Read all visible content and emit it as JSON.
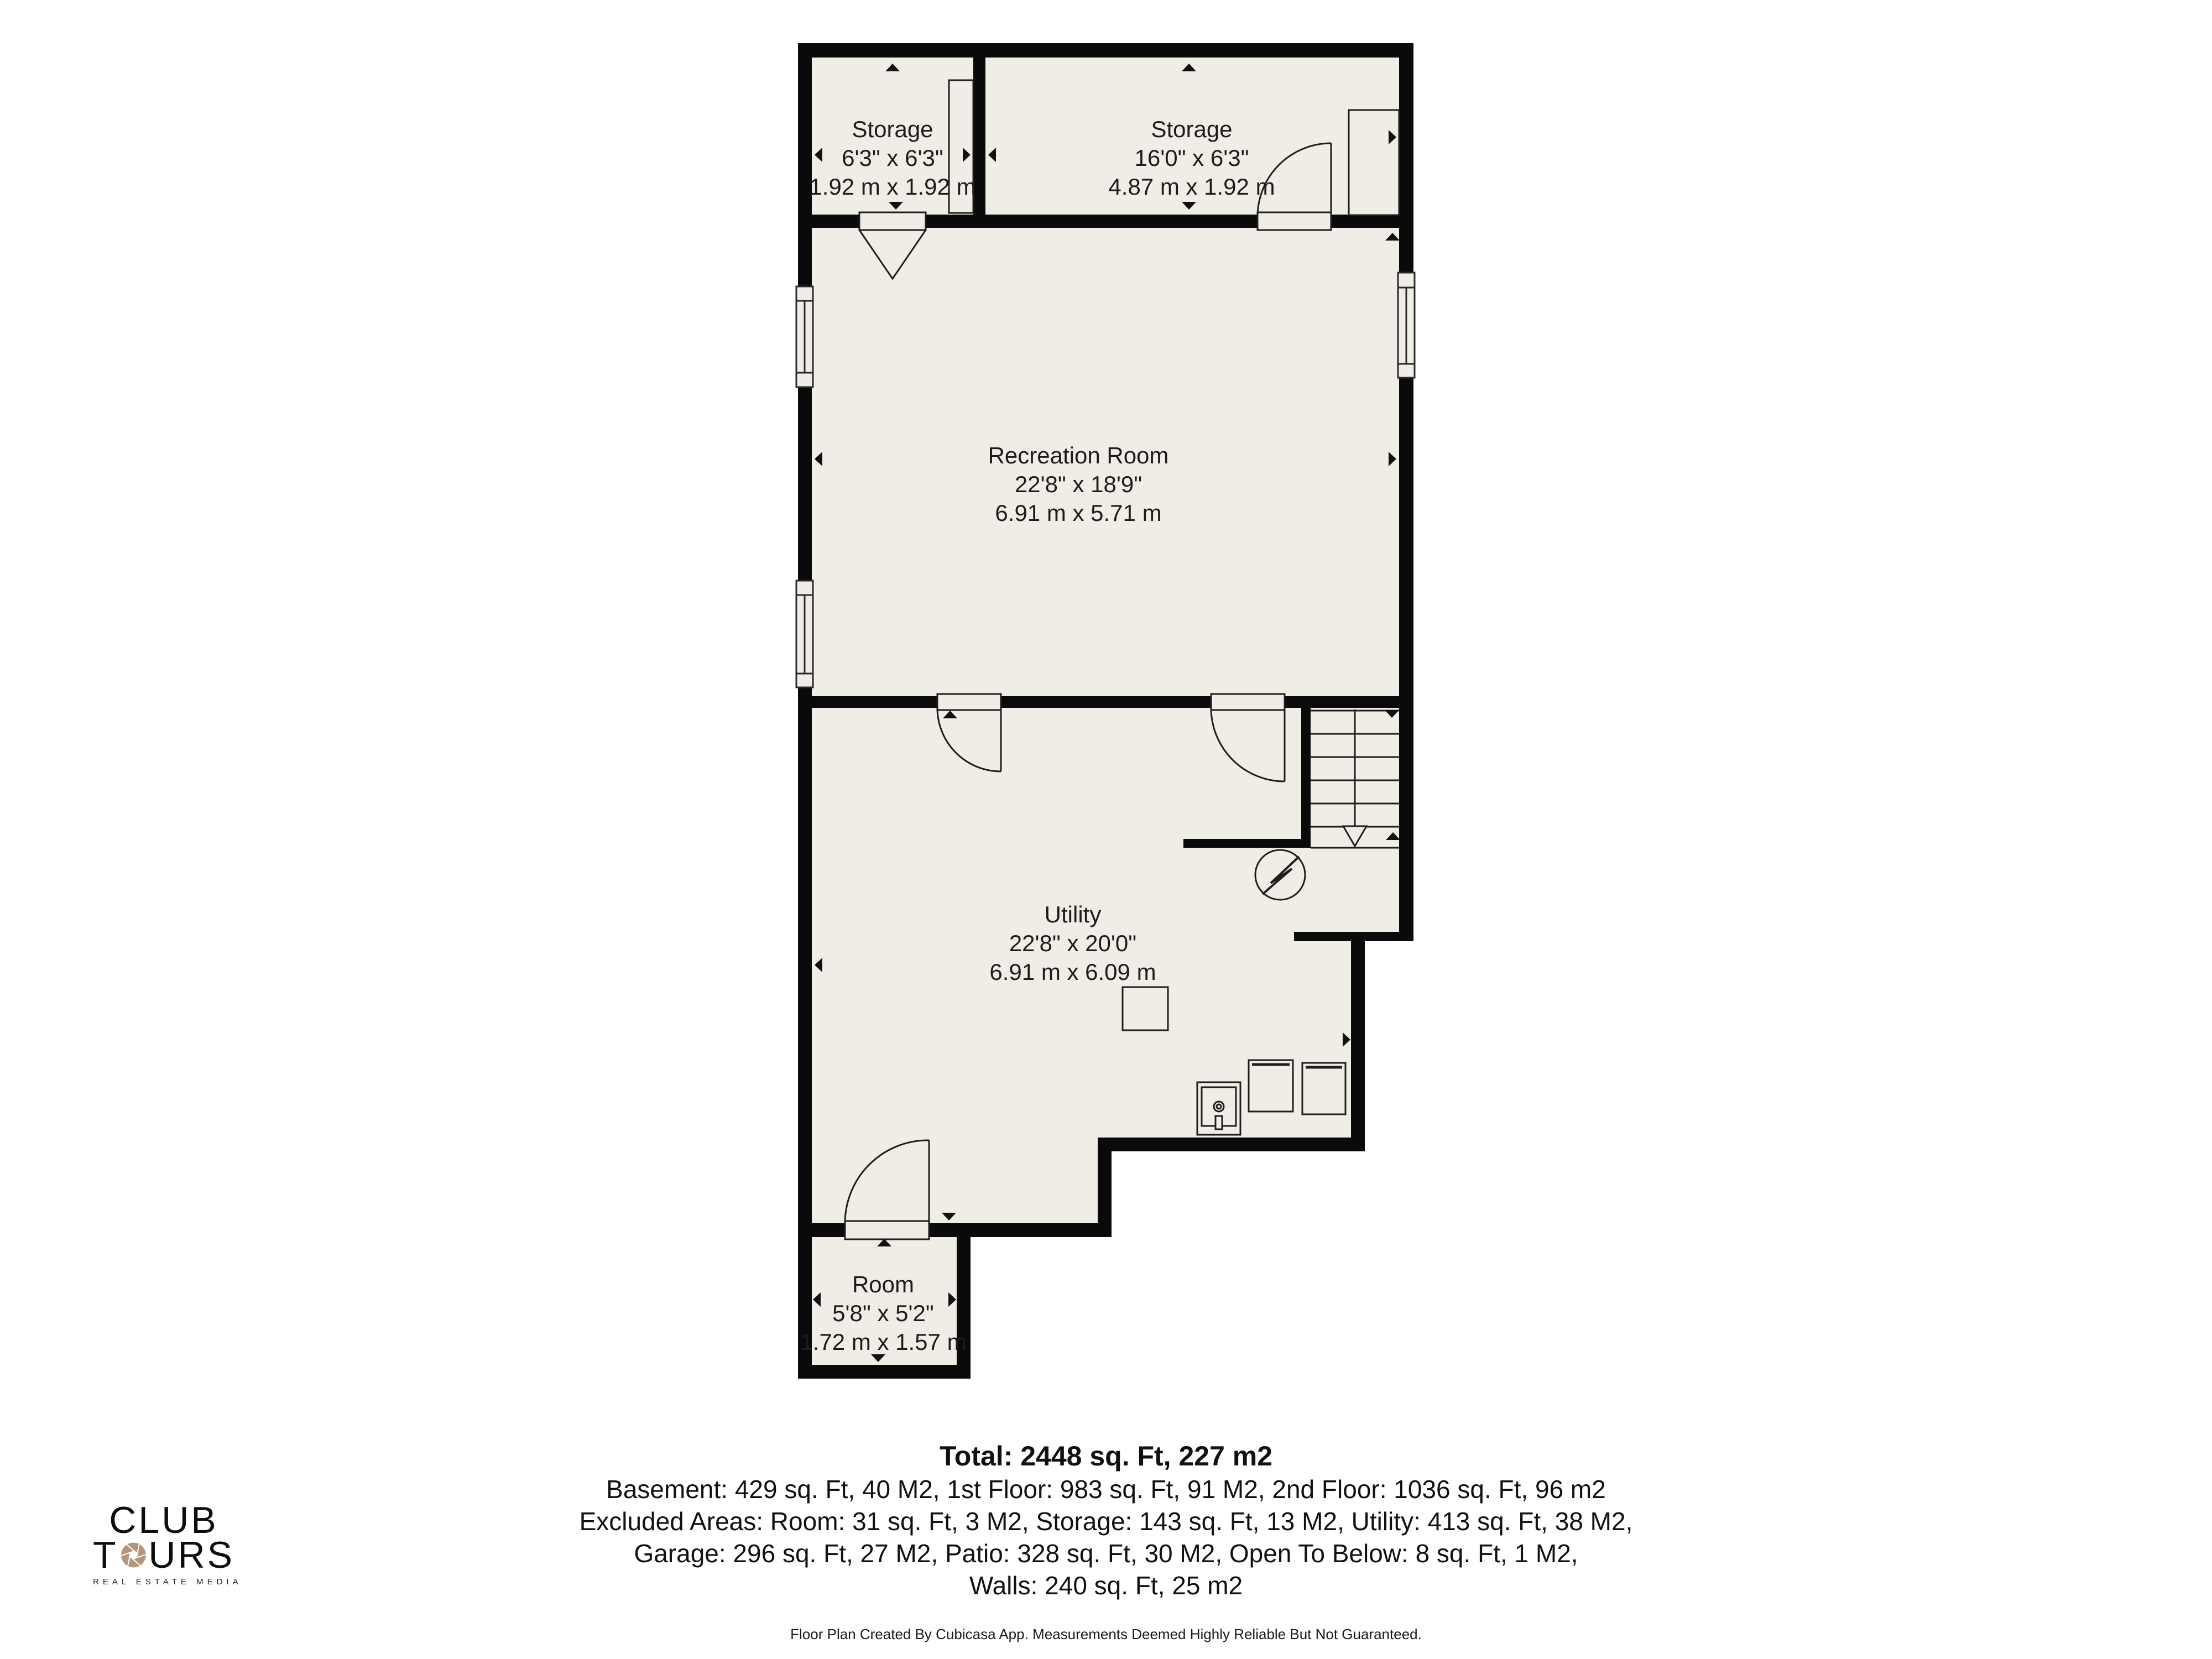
{
  "colors": {
    "floor": "#f0ede6",
    "wall": "#0a0a0a",
    "line": "#1e1e1e",
    "logo_accent": "#b39579"
  },
  "floor_plan": {
    "rooms": [
      {
        "id": "storage-left",
        "name": "Storage",
        "imperial": "6'3\" x 6'3\"",
        "metric": "1.92 m x 1.92 m"
      },
      {
        "id": "storage-right",
        "name": "Storage",
        "imperial": "16'0\" x 6'3\"",
        "metric": "4.87 m x 1.92 m"
      },
      {
        "id": "recreation",
        "name": "Recreation Room",
        "imperial": "22'8\" x 18'9\"",
        "metric": "6.91 m x 5.71 m"
      },
      {
        "id": "utility",
        "name": "Utility",
        "imperial": "22'8\" x 20'0\"",
        "metric": "6.91 m x 6.09 m"
      },
      {
        "id": "room",
        "name": "Room",
        "imperial": "5'8\" x 5'2\"",
        "metric": "1.72 m x 1.57 m"
      }
    ],
    "summary": {
      "total": "Total: 2448 sq. Ft, 227 m2",
      "line1": "Basement: 429 sq. Ft, 40 M2, 1st Floor: 983 sq. Ft, 91 M2, 2nd Floor: 1036 sq. Ft, 96 m2",
      "line2": "Excluded Areas: Room: 31 sq. Ft, 3 M2, Storage: 143 sq. Ft, 13 M2, Utility: 413 sq. Ft, 38 M2,",
      "line3": "Garage: 296 sq. Ft, 27 M2, Patio: 328 sq. Ft, 30 M2, Open To Below: 8 sq. Ft, 1 M2,",
      "line4": "Walls: 240 sq. Ft, 25 m2"
    },
    "disclaimer": "Floor Plan Created By Cubicasa App. Measurements Deemed Highly Reliable But Not Guaranteed."
  },
  "logo": {
    "line1": "CLUB",
    "tours_t": "T",
    "tours_rest": "URS",
    "tagline": "REAL ESTATE MEDIA"
  }
}
